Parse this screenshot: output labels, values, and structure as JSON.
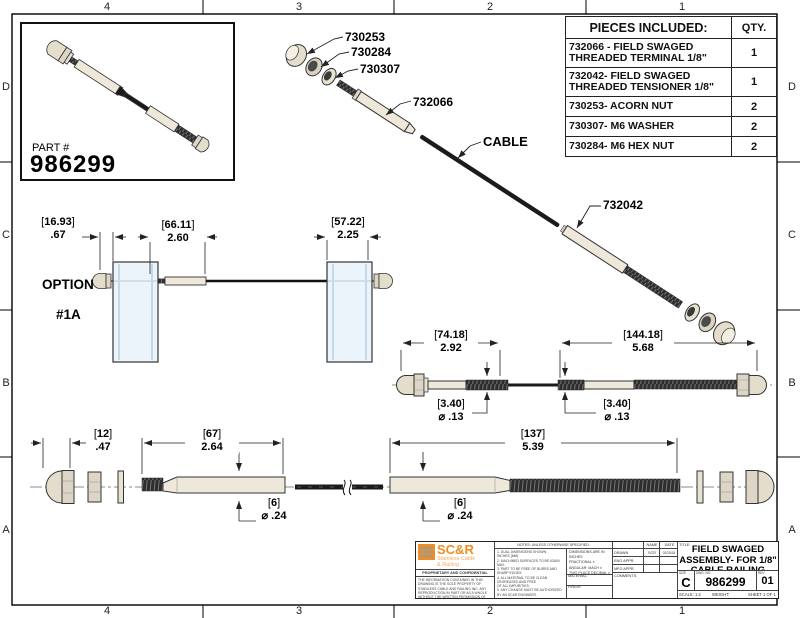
{
  "zones": {
    "top": [
      "4",
      "3",
      "2",
      "1"
    ],
    "bottom": [
      "4",
      "3",
      "2",
      "1"
    ],
    "left": [
      "D",
      "C",
      "B",
      "A"
    ],
    "right": [
      "D",
      "C",
      "B",
      "A"
    ]
  },
  "inset": {
    "part_label": "PART #",
    "part_number": "986299"
  },
  "parts_table": {
    "header": "PIECES INCLUDED:",
    "qty_header": "QTY.",
    "rows": [
      {
        "desc": "732066 - FIELD SWAGED THREADED TERMINAL 1/8\"",
        "qty": "1"
      },
      {
        "desc": "732042- FIELD SWAGED THREADED TENSIONER 1/8\"",
        "qty": "1"
      },
      {
        "desc": "730253- ACORN NUT",
        "qty": "2"
      },
      {
        "desc": "730307- M6 WASHER",
        "qty": "2"
      },
      {
        "desc": "730284- M6 HEX NUT",
        "qty": "2"
      }
    ]
  },
  "callouts": {
    "acorn_nut": "730253",
    "hex_nut": "730284",
    "washer": "730307",
    "terminal": "732066",
    "cable": "CABLE",
    "tensioner": "732042"
  },
  "option_view": {
    "line1": "OPTION",
    "line2": "#1A"
  },
  "dims": {
    "opt_gap": {
      "mm": "16.93",
      "in": ".67"
    },
    "opt_fit": {
      "mm": "66.11",
      "in": "2.60"
    },
    "opt_post": {
      "mm": "57.22",
      "in": "2.25"
    },
    "asm_l": {
      "mm": "74.18",
      "in": "2.92"
    },
    "asm_r": {
      "mm": "144.18",
      "in": "5.68"
    },
    "asm_d1": {
      "mm": "3.40",
      "in": "⌀ .13"
    },
    "asm_d2": {
      "mm": "3.40",
      "in": "⌀ .13"
    },
    "exp_nut": {
      "mm": "12",
      "in": ".47"
    },
    "exp_term": {
      "mm": "67",
      "in": "2.64"
    },
    "exp_d1": {
      "mm": "6",
      "in": "⌀ .24"
    },
    "exp_tens": {
      "mm": "137",
      "in": "5.39"
    },
    "exp_d2": {
      "mm": "6",
      "in": "⌀ .24"
    }
  },
  "title_block": {
    "logo_name": "SC&R",
    "logo_sub1": "Stainless Cable",
    "logo_sub2": "& Railing",
    "proprietary_title": "PROPRIETARY AND CONFIDENTIAL",
    "proprietary_text": "THE INFORMATION CONTAINED IN THIS DRAWING IS THE SOLE PROPERTY OF STAINLESS CABLE AND RAILING INC. ANY REPRODUCTION IN PART OR AS A WHOLE WITHOUT THE WRITTEN PERMISSION OF STAINLESS CABLE AND RAILING INC. IS PROHIBITED.",
    "notes_header": "NOTES: UNLESS OTHERWISE SPECIFIED:",
    "notes_body": "1. DUAL DIMENSIONS SHOWN:\nINCHES [MM]\n2. MACHINED SURFACES TO BE 63UIN\nMAX.\n3. PART TO BE FREE OF BURRS AND\nSHARP EDGES.\n4. ALL MATERIAL TO BE CLEAN\nDEGREASED AND FREE\nOF ALL IMPURITIES.\n5. ANY CHANGE MUST BE AUTHORIZED\nBY AN SC&R ENGINEER.",
    "tolerances": "DIMENSIONS ARE IN INCHES\nFRACTIONAL ±\nANGULAR: MACH ±\nTWO PLACE DECIMAL ±\nTHREE PLACE DECIMAL ±",
    "material_label": "MATERIAL",
    "finish_label": "FINISH",
    "name_header": "NAME",
    "date_header": "DATE",
    "drawn_label": "DRAWN",
    "drawn_name": "SCR",
    "drawn_date": "03/25/18",
    "eng_label": "ENG APPR.",
    "mfg_label": "MFG APPR.",
    "comments_label": "COMMENTS:",
    "title_label": "TITLE:",
    "title_line1": "FIELD SWAGED",
    "title_line2": "ASSEMBLY- FOR 1/8\"",
    "title_line3": "CABLE RAILING",
    "size_label": "SIZE",
    "size_value": "C",
    "dwg_label": "DWG.  NO.",
    "dwg_value": "986299",
    "rev_label": "REV",
    "rev_value": "01",
    "scale": "SCALE: 1:2",
    "weight": "WEIGHT:",
    "sheet": "SHEET 1 OF 1"
  },
  "colors": {
    "accent_orange": "#ee8d21",
    "line": "#222222",
    "post_fill": "#e7f2fa"
  }
}
